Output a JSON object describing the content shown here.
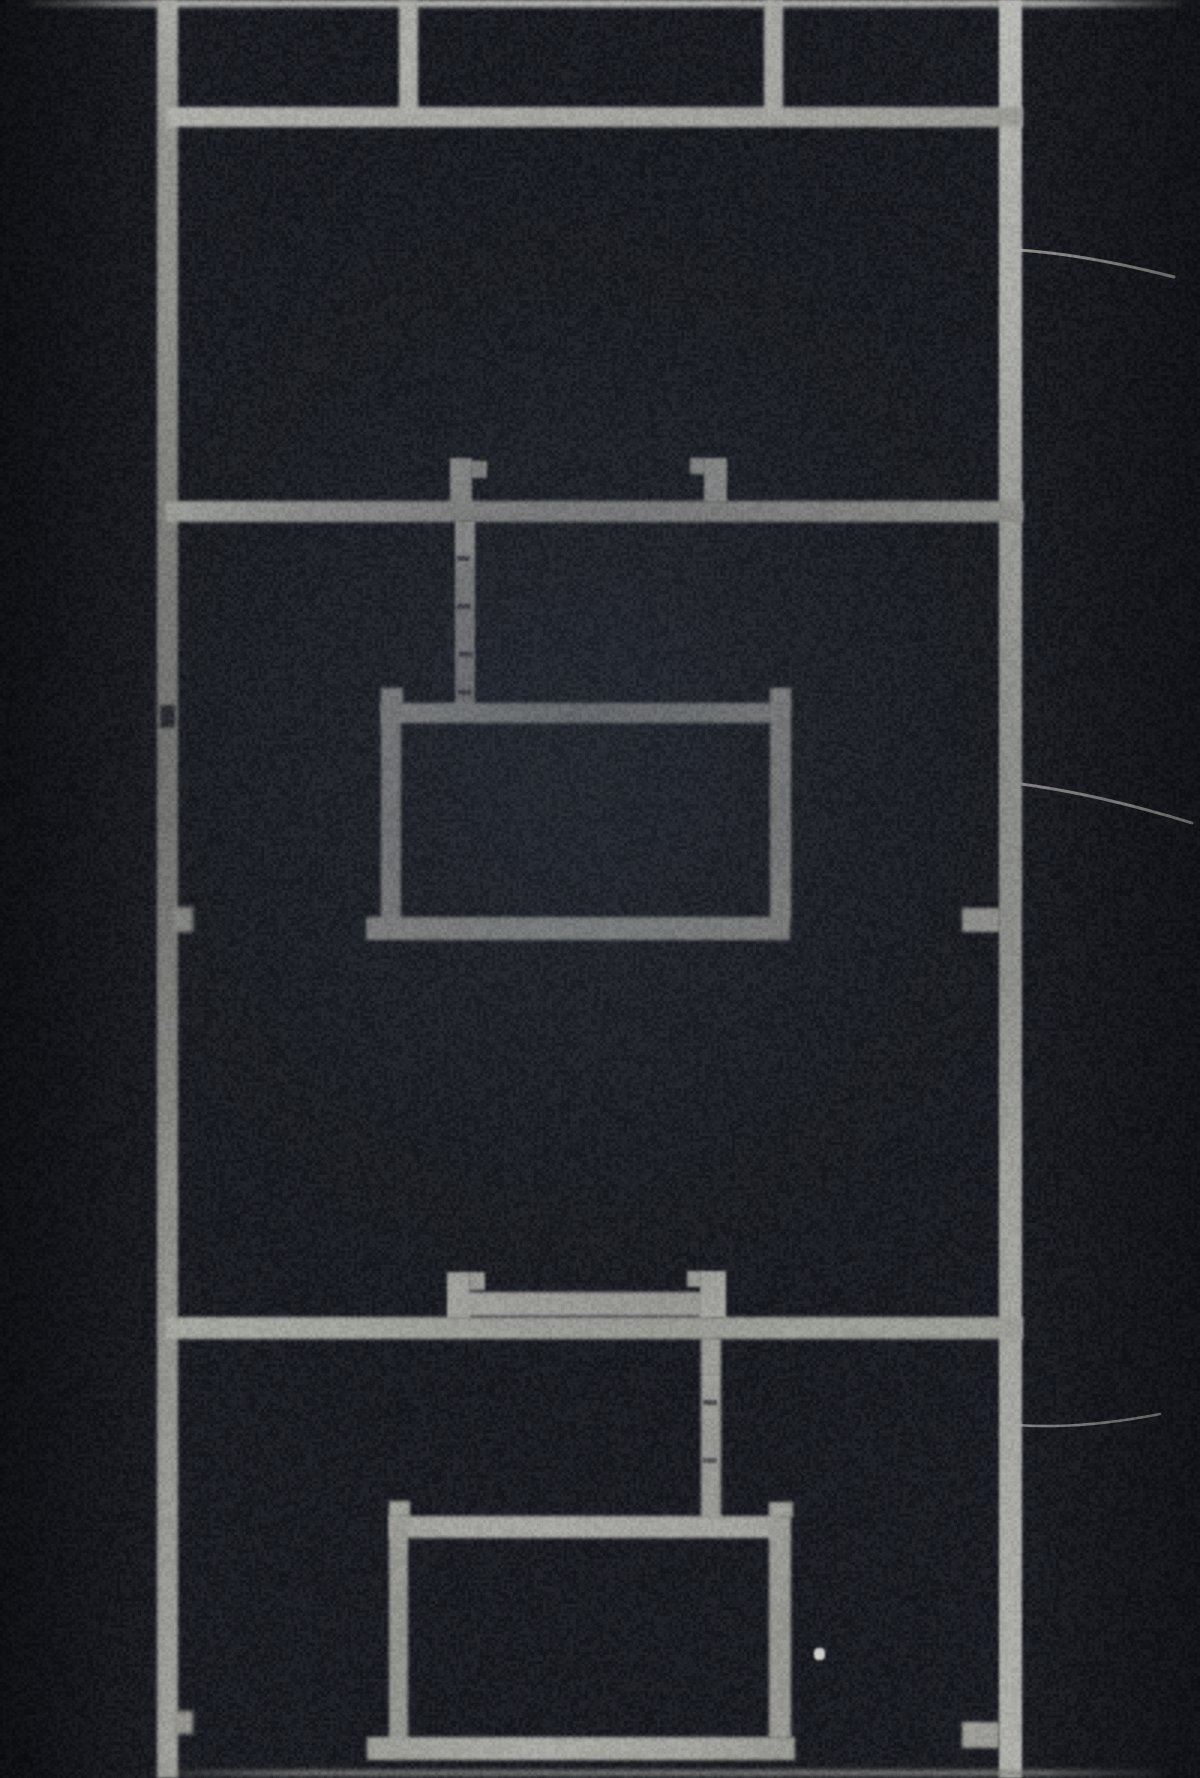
{
  "image": {
    "kind": "black-and-white-photograph",
    "description": "Grainy monochrome photograph of a minimalist welded metal construction: two tall vertical rails joined by horizontal shelf bars, with small hook tabs and thin rods suspending two open rectangular frames; three fine wires extend from the right rail toward the right edge.",
    "canvas": {
      "width": 1200,
      "height": 1778
    },
    "palette": {
      "background": "#0b0e13",
      "metal_bright": "#c4c4be",
      "metal_mid": "#a8a8a1",
      "metal_dim": "#8d8d86",
      "shadow_notch": "#14171c",
      "dust_speck": "#dcdcd6",
      "wire": "#b5b5ae"
    },
    "grain": {
      "seed": 7,
      "coarse_alpha": 26,
      "fine_alpha": 13
    },
    "elements": [
      {
        "name": "top-edge-bar",
        "x": 30,
        "y": 0,
        "w": 1150,
        "h": 7,
        "fill": "linear-gradient(90deg, rgba(150,150,144,0.2), #bcbcb6 12%, #c6c6c0 50%, #b8b8b2 90%, rgba(150,150,144,0.2))",
        "blur": 2.2
      },
      {
        "name": "left-rail",
        "x": 157,
        "y": 0,
        "w": 21,
        "h": 1778,
        "fill": "linear-gradient(180deg,#b2b2ac 0%,#96968f 8%,#8d8d86 30%,#83837d 45%,#8d8d86 62%,#9a9a93 80%,#a5a59e 100%)",
        "blur": 1.6
      },
      {
        "name": "right-rail",
        "x": 999,
        "y": 0,
        "w": 23,
        "h": 1778,
        "fill": "linear-gradient(180deg,#c4c4be 0%,#b5b5af 12%,#a9a9a2 35%,#9d9d96 55%,#ababa4 75%,#b8b8b1 100%)",
        "blur": 1.4
      },
      {
        "name": "shelf-bar-1",
        "x": 166,
        "y": 107,
        "w": 857,
        "h": 20,
        "fill": "linear-gradient(90deg,#b7b7b0,#acaca5 55%,#a0a099 100%)",
        "blur": 1.6
      },
      {
        "name": "hanger-drop-left",
        "x": 399,
        "y": 0,
        "w": 19,
        "h": 114,
        "fill": "#b3b3ad",
        "blur": 1.6
      },
      {
        "name": "hanger-drop-right",
        "x": 764,
        "y": 0,
        "w": 19,
        "h": 114,
        "fill": "#adada7",
        "blur": 1.6
      },
      {
        "name": "shelf-bar-2",
        "x": 166,
        "y": 501,
        "w": 857,
        "h": 21,
        "fill": "linear-gradient(90deg,#b5b5ae,#a9a9a2 50%,#9b9b94)",
        "blur": 1.6
      },
      {
        "name": "hook-tab-a-body",
        "x": 450,
        "y": 458,
        "w": 22,
        "h": 47,
        "fill": "#b0b0a9",
        "blur": 1.4
      },
      {
        "name": "hook-tab-a-ear",
        "x": 471,
        "y": 461,
        "w": 16,
        "h": 17,
        "fill": "#a9a9a2",
        "blur": 1.4
      },
      {
        "name": "hook-tab-b-ear",
        "x": 690,
        "y": 458,
        "w": 15,
        "h": 16,
        "fill": "#a7a7a0",
        "blur": 1.4
      },
      {
        "name": "hook-tab-b-body",
        "x": 704,
        "y": 458,
        "w": 23,
        "h": 44,
        "fill": "#b0b0a9",
        "blur": 1.4
      },
      {
        "name": "hanging-rod-upper",
        "x": 455,
        "y": 521,
        "w": 20,
        "h": 186,
        "fill": "linear-gradient(180deg,#bcbcb5 0%,#bcbcb5 18%,#a3a39c 24%,#a09f99 70%,#989891 100%)",
        "blur": 1.4
      },
      {
        "name": "rod-joint-mark",
        "x": 457,
        "y": 556,
        "w": 13,
        "h": 5,
        "fill": "rgba(18,21,27,0.7)",
        "blur": 1
      },
      {
        "name": "rod-joint-mark",
        "x": 457,
        "y": 604,
        "w": 13,
        "h": 5,
        "fill": "rgba(18,21,27,0.7)",
        "blur": 1
      },
      {
        "name": "rod-joint-mark",
        "x": 459,
        "y": 652,
        "w": 13,
        "h": 5,
        "fill": "rgba(18,21,27,0.7)",
        "blur": 1
      },
      {
        "name": "rod-joint-mark",
        "x": 458,
        "y": 690,
        "w": 13,
        "h": 5,
        "fill": "rgba(18,21,27,0.6)",
        "blur": 1
      },
      {
        "name": "frame1-top-bar",
        "x": 381,
        "y": 703,
        "w": 401,
        "h": 20,
        "fill": "linear-gradient(90deg,#b1b1aa,#a8a8a1 60%,#9f9f98)",
        "blur": 1.5
      },
      {
        "name": "frame1-stub-left",
        "x": 381,
        "y": 688,
        "w": 22,
        "h": 17,
        "fill": "#a8a8a1",
        "blur": 1.5
      },
      {
        "name": "frame1-stub-right",
        "x": 770,
        "y": 688,
        "w": 21,
        "h": 17,
        "fill": "#a8a8a1",
        "blur": 1.5
      },
      {
        "name": "frame1-post-left",
        "x": 381,
        "y": 703,
        "w": 20,
        "h": 217,
        "fill": "linear-gradient(180deg,#a5a59e,#9a9a93 60%,#a2a29b)",
        "blur": 1.5
      },
      {
        "name": "frame1-post-right",
        "x": 770,
        "y": 703,
        "w": 21,
        "h": 217,
        "fill": "linear-gradient(180deg,#a8a8a1,#9e9e97 50%,#a6a69f)",
        "blur": 1.5
      },
      {
        "name": "frame1-bottom-bar",
        "x": 366,
        "y": 917,
        "w": 424,
        "h": 23,
        "fill": "linear-gradient(90deg,#a5a59e,#b6b6af 45%,#b0b0a9 70%,#a2a29b)",
        "blur": 1.5
      },
      {
        "name": "left-rail-dark-notch",
        "x": 160,
        "y": 705,
        "w": 15,
        "h": 23,
        "fill": "#14171c",
        "blur": 1.5,
        "opacity": 0.9
      },
      {
        "name": "left-rail-nub-mid",
        "x": 173,
        "y": 907,
        "w": 20,
        "h": 25,
        "fill": "#9b9b94",
        "blur": 2
      },
      {
        "name": "right-rail-stub-mid",
        "x": 962,
        "y": 908,
        "w": 38,
        "h": 24,
        "fill": "#a8a8a1",
        "blur": 1.6
      },
      {
        "name": "bracket-tab-left-body",
        "x": 447,
        "y": 1272,
        "w": 23,
        "h": 46,
        "fill": "#b3b3ac",
        "blur": 1.4
      },
      {
        "name": "bracket-tab-left-ear",
        "x": 469,
        "y": 1272,
        "w": 16,
        "h": 18,
        "fill": "#ababa4",
        "blur": 1.4
      },
      {
        "name": "bracket-cross-bar",
        "x": 466,
        "y": 1292,
        "w": 236,
        "h": 24,
        "fill": "linear-gradient(90deg,#b0b0a9,#aaaaa3 60%,#a6a69f)",
        "blur": 1.5
      },
      {
        "name": "bracket-tab-right-ear",
        "x": 687,
        "y": 1271,
        "w": 14,
        "h": 16,
        "fill": "#a9a9a2",
        "blur": 1.4
      },
      {
        "name": "bracket-tab-right-body",
        "x": 700,
        "y": 1271,
        "w": 26,
        "h": 47,
        "fill": "#b3b3ac",
        "blur": 1.4
      },
      {
        "name": "shelf-bar-3",
        "x": 166,
        "y": 1317,
        "w": 857,
        "h": 22,
        "fill": "linear-gradient(90deg,#aeaea7,#a8a8a1 50%,#a2a29b)",
        "blur": 1.6
      },
      {
        "name": "hanging-rod-lower",
        "x": 701,
        "y": 1338,
        "w": 20,
        "h": 180,
        "fill": "linear-gradient(180deg,#a5a59e,#9c9c95 55%,#a0a099)",
        "blur": 1.5
      },
      {
        "name": "rod-joint-mark",
        "x": 703,
        "y": 1400,
        "w": 14,
        "h": 5,
        "fill": "rgba(18,21,27,0.65)",
        "blur": 1
      },
      {
        "name": "rod-joint-mark",
        "x": 703,
        "y": 1458,
        "w": 14,
        "h": 5,
        "fill": "rgba(18,21,27,0.55)",
        "blur": 1
      },
      {
        "name": "frame2-top-bar",
        "x": 389,
        "y": 1516,
        "w": 391,
        "h": 22,
        "fill": "linear-gradient(90deg,#a9a9a2,#b0b0a9 40%,#aaaaa3)",
        "blur": 1.5
      },
      {
        "name": "frame2-stub-left",
        "x": 389,
        "y": 1501,
        "w": 21,
        "h": 16,
        "fill": "#a5a59e",
        "blur": 1.5
      },
      {
        "name": "frame2-stub-right",
        "x": 769,
        "y": 1502,
        "w": 24,
        "h": 15,
        "fill": "#a5a59e",
        "blur": 1.5
      },
      {
        "name": "frame2-post-left",
        "x": 389,
        "y": 1516,
        "w": 19,
        "h": 224,
        "fill": "linear-gradient(180deg,#a09f99,#96968f 60%,#9b9b94)",
        "blur": 1.5
      },
      {
        "name": "frame2-post-right",
        "x": 769,
        "y": 1516,
        "w": 22,
        "h": 222,
        "fill": "linear-gradient(180deg,#a3a39c,#9a9a93 55%,#a09f99)",
        "blur": 1.5
      },
      {
        "name": "frame2-bottom-bar",
        "x": 367,
        "y": 1737,
        "w": 428,
        "h": 23,
        "fill": "linear-gradient(90deg,#a2a29b,#b2b2ab 40%,#acaca5 75%,#9e9e97)",
        "blur": 1.6
      },
      {
        "name": "left-rail-nub-bottom",
        "x": 174,
        "y": 1711,
        "w": 19,
        "h": 23,
        "fill": "#99998f",
        "blur": 2
      },
      {
        "name": "right-rail-stub-bottom",
        "x": 962,
        "y": 1722,
        "w": 37,
        "h": 26,
        "fill": "#a2a29b",
        "blur": 1.7
      },
      {
        "name": "bottom-edge-bar",
        "x": 150,
        "y": 1770,
        "w": 1010,
        "h": 6,
        "fill": "linear-gradient(90deg, rgba(133,133,127,0.1), #85857f 15%, #8f8f89 55%, #85857f 88%, rgba(133,133,127,0.1))",
        "blur": 2.4,
        "opacity": 0.8
      },
      {
        "name": "dust-speck",
        "x": 814,
        "y": 1648,
        "w": 11,
        "h": 12,
        "fill": "#dcdcd6",
        "blur": 1,
        "radius": 4
      }
    ],
    "wires": [
      {
        "name": "wire-upper",
        "path": "M1019,250 C1062,253 1112,261 1174,277",
        "stroke_width": 3,
        "opacity": 0.8
      },
      {
        "name": "wire-middle",
        "path": "M1021,784 C1066,790 1124,802 1192,823",
        "stroke_width": 3,
        "opacity": 0.8
      },
      {
        "name": "wire-lower",
        "path": "M1004,1424 C1052,1429 1104,1425 1160,1414",
        "stroke_width": 2.6,
        "opacity": 0.7
      }
    ]
  }
}
